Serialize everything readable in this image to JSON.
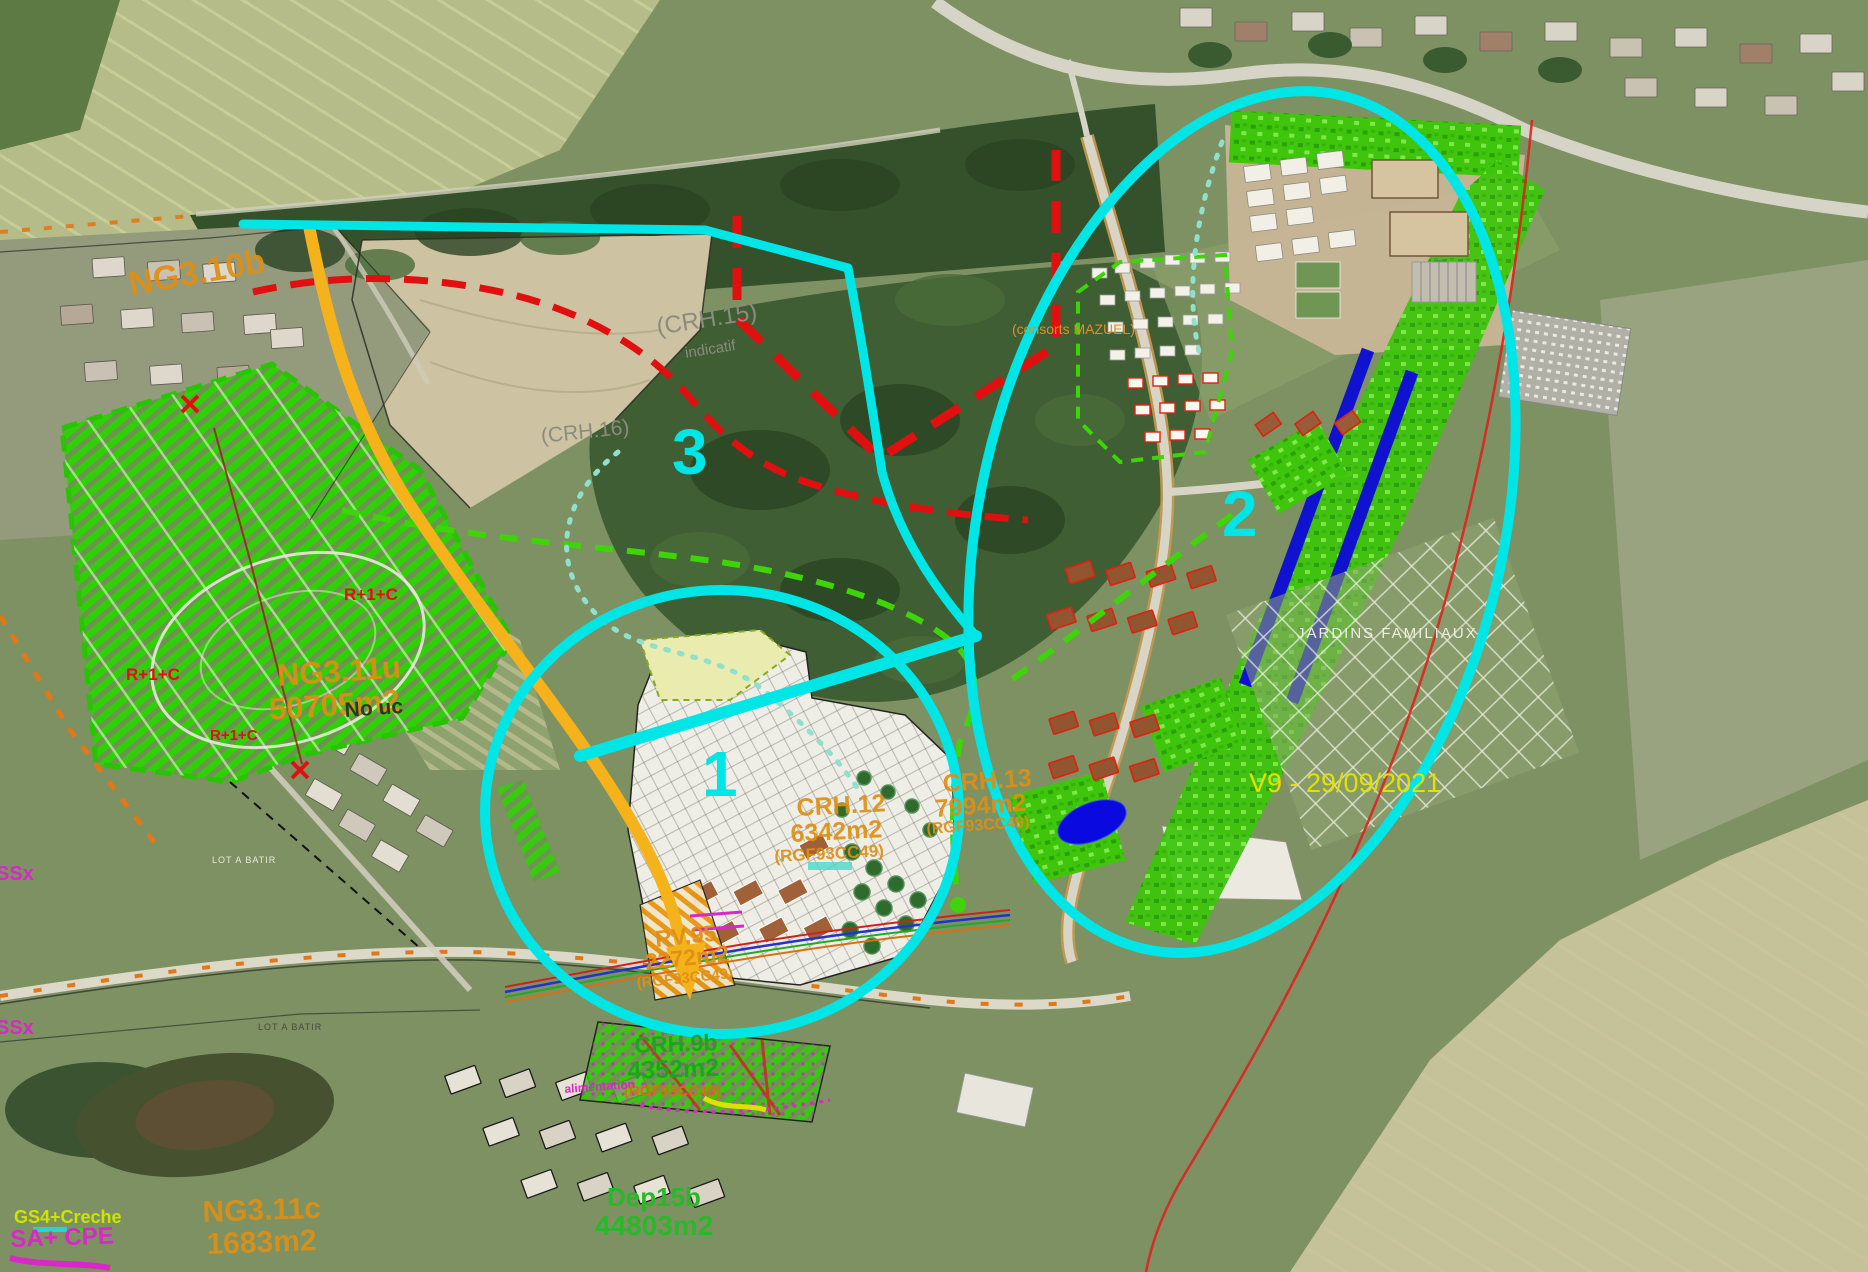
{
  "zones": [
    {
      "number": "1"
    },
    {
      "number": "2"
    },
    {
      "number": "3"
    }
  ],
  "parcels": [
    {
      "id": "CRH.12",
      "area": "6342m2",
      "ref": "(RGF93CC49)"
    },
    {
      "id": "CRH.13",
      "area": "7994m2",
      "ref": "(RGF93CC49)"
    },
    {
      "id": "RV.95",
      "area": "2272m2",
      "ref": "(RGF93CC49)"
    },
    {
      "id": "CRH.9b",
      "area": "4352m2",
      "ref": "(RGF93CC49)"
    },
    {
      "id": "NG3.11u",
      "area": "50705m2"
    },
    {
      "id": "NG3.11c",
      "area": "1683m2"
    },
    {
      "id": "Dep15b",
      "area": "44803m2"
    },
    {
      "id": "NG3.10b"
    }
  ],
  "labels": {
    "crh15": "(CRH.15)",
    "crh15_sub": "indicatif",
    "crh16": "(CRH.16)",
    "consorts": "(consorts MAZUEL)",
    "no_uc": "No uc",
    "r1c": "R+1+C",
    "jardins": "JARDINS FAMILIAUX",
    "version": "V9 - 29/09/2021",
    "gs4": "GS4+Creche",
    "cpe": "SA+ CPE",
    "lot_a_batir": "LOT A BATIR",
    "ssx": "SSx",
    "alim": "alimentation"
  },
  "colors": {
    "annotation_cyan": "#00e6e6",
    "red_dash": "#e01010",
    "green_dash": "#3ed409",
    "teal_dot": "#8fe0cc",
    "arrow_orange": "#f6b21a",
    "orange_label": "#dd8f15",
    "green_label": "#20a320",
    "magenta_label": "#d828c8",
    "yellow_label": "#e4e000",
    "gray_label": "#8b8b7f"
  }
}
